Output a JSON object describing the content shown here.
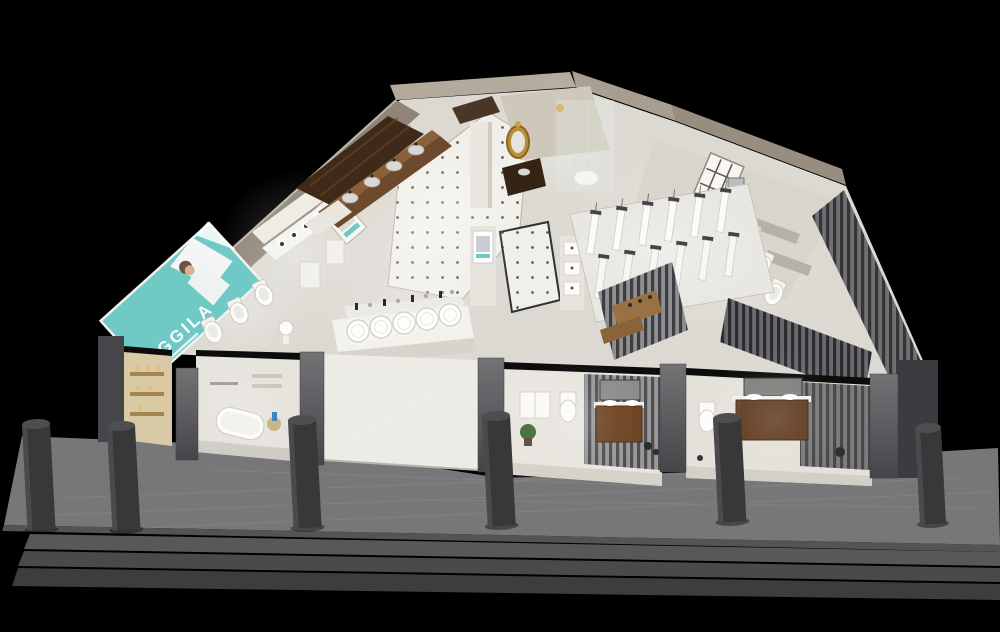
{
  "brand": {
    "name": "AGGILA"
  },
  "palette": {
    "background": "#000000",
    "accent_teal": "#6fc9c5",
    "billboard_text": "#ffffff",
    "floor_light": "#dcd9d2",
    "tile_white": "#f1efe9",
    "wall_beige": "#a89e8f",
    "wood_dark": "#4a2f1c",
    "wood_mid": "#6e4a2c",
    "wood_vanity": "#5f3a1e",
    "gold": "#b98f3e",
    "pillar_gray": "#636366",
    "bollard_gray": "#38383a",
    "walkway_gray": "#77777a",
    "frame_black": "#0c0c0c",
    "fixture_white": "#fcfcfa",
    "foliage_green": "#3e6b34",
    "bottle_blue": "#3a7bbf"
  }
}
